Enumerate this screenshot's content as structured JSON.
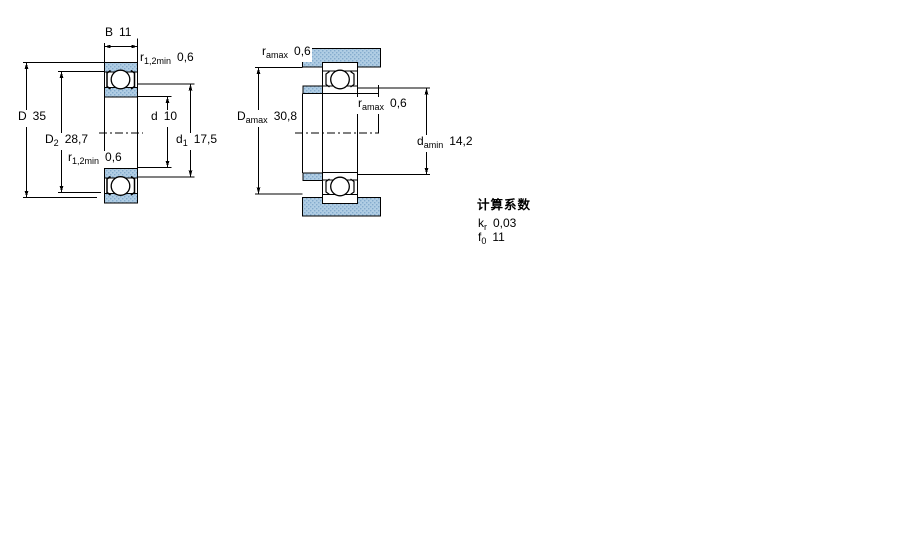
{
  "colors": {
    "hatch_fill": "#b0cde4",
    "hatch_dot": "#84abcd",
    "line": "#000000",
    "background": "#ffffff"
  },
  "left_diagram": {
    "description": "bearing cross-section with boundary dimensions",
    "labels": {
      "b": {
        "symbol": "B",
        "sub": "",
        "value": "11"
      },
      "r12_top": {
        "symbol": "r",
        "sub": "1,2min",
        "value": "0,6"
      },
      "D": {
        "symbol": "D",
        "sub": "",
        "value": "35"
      },
      "D2": {
        "symbol": "D",
        "sub": "2",
        "value": "28,7"
      },
      "d": {
        "symbol": "d",
        "sub": "",
        "value": "10"
      },
      "d1": {
        "symbol": "d",
        "sub": "1",
        "value": "17,5"
      },
      "r12_inner": {
        "symbol": "r",
        "sub": "1,2min",
        "value": "0,6"
      }
    }
  },
  "right_diagram": {
    "description": "bearing abutment / fillet dimensions in housing and on shaft",
    "labels": {
      "ra_top": {
        "symbol": "r",
        "sub": "amax",
        "value": "0,6"
      },
      "Da_max": {
        "symbol": "D",
        "sub": "amax",
        "value": "30,8"
      },
      "ra_mid": {
        "symbol": "r",
        "sub": "amax",
        "value": "0,6"
      },
      "da_min": {
        "symbol": "d",
        "sub": "amin",
        "value": "14,2"
      }
    }
  },
  "calculation_factors": {
    "title": "计算系数",
    "kr": {
      "symbol": "k",
      "sub": "r",
      "value": "0,03"
    },
    "f0": {
      "symbol": "f",
      "sub": "0",
      "value": "11"
    }
  }
}
